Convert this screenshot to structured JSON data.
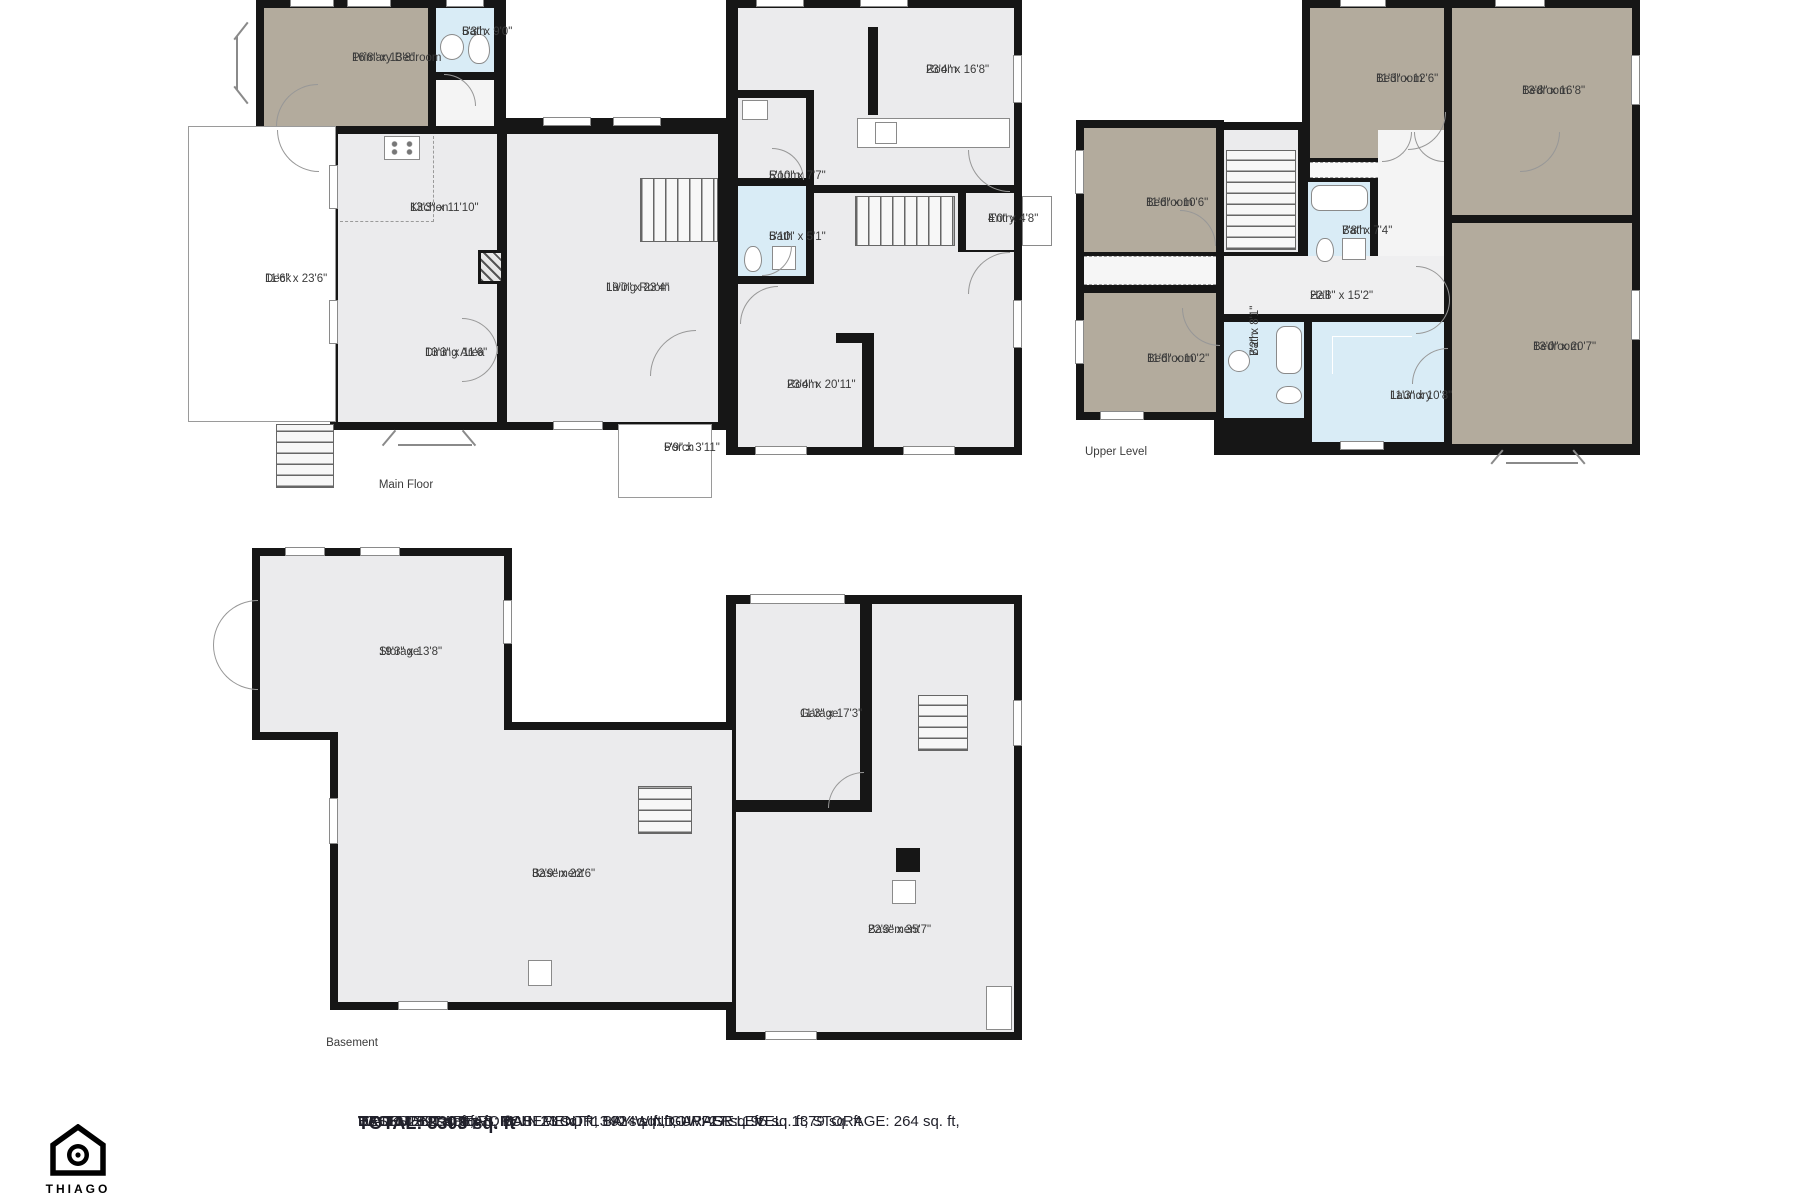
{
  "colors": {
    "wall": "#161616",
    "bedroom": "#b3ab9d",
    "bath": "#d9ecf6",
    "room": "#ebebed",
    "hall": "#efeff0",
    "label_text": "#3b3b3b",
    "summary_text": "#21212b"
  },
  "floors": {
    "main": {
      "label": "Main Floor",
      "rooms": {
        "deck": {
          "name": "Deck",
          "dims": "11'6\" x 23'6\""
        },
        "primary_bedroom": {
          "name": "Primary Bedroom",
          "dims": "16'8\" x 13'8\""
        },
        "bath": {
          "name": "Bath",
          "dims": "5'3\" x 9'0\""
        },
        "kitchen": {
          "name": "Kitchen",
          "dims": "13'3\" x 11'10\""
        },
        "dining": {
          "name": "Dining Area",
          "dims": "13'3\" x 11'6\""
        },
        "living": {
          "name": "Living Room",
          "dims": "19'0\" x 23'4\""
        },
        "room_top": {
          "name": "Room",
          "dims": "23'4\" x 16'8\""
        },
        "room_small": {
          "name": "Room",
          "dims": "5'10\" x 7'7\""
        },
        "bath_small": {
          "name": "Bath",
          "dims": "5'10\" x 5'1\""
        },
        "entry": {
          "name": "Entry",
          "dims": "4'0\" x 4'8\""
        },
        "room_bottom": {
          "name": "Room",
          "dims": "23'4\" x 20'11\""
        },
        "porch": {
          "name": "Porch",
          "dims": "5'9\" x 3'11\""
        }
      }
    },
    "upper": {
      "label": "Upper Level",
      "rooms": {
        "bedroom_top_left": {
          "name": "Bedroom",
          "dims": "11'3\" x 12'6\""
        },
        "bedroom_top_right": {
          "name": "Bedroom",
          "dims": "13'8\" x 16'8\""
        },
        "bedroom_left_top": {
          "name": "Bedroom",
          "dims": "11'6\" x 10'6\""
        },
        "bedroom_left_bottom": {
          "name": "Bedroom",
          "dims": "11'6\" x 10'2\""
        },
        "bath_top": {
          "name": "Bath",
          "dims": "7'8\" x 7'4\""
        },
        "hall": {
          "name": "Hall",
          "dims": "22'8\" x 15'2\""
        },
        "bath_bottom": {
          "name": "Bath",
          "dims": "7'2\" x 8'1\""
        },
        "laundry": {
          "name": "Laundry",
          "dims": "11'3\" x 10'8\""
        },
        "bedroom_right": {
          "name": "Bedroom",
          "dims": "13'0\" x 20'7\""
        }
      }
    },
    "basement": {
      "label": "Basement",
      "rooms": {
        "storage": {
          "name": "Storage",
          "dims": "19'3\" x 13'8\""
        },
        "basement_left": {
          "name": "Basement",
          "dims": "32'9\" x 22'6\""
        },
        "garage": {
          "name": "Garage",
          "dims": "11'3\" x 17'3\""
        },
        "basement_right": {
          "name": "Basement",
          "dims": "22'3\" x 35'7\""
        }
      }
    }
  },
  "summary": {
    "total": "TOTAL: 3303 sq. ft",
    "line1": "BASEMENT: 0 sq. ft, MAIN FLOOR: 1924 sq. ft, UPPER LEVEL: 1379 sq. ft",
    "line2": "EXCLUDED AREAS: BASEMENT: 1340 sq. ft, GARAGE: 195 sq. ft, STORAGE: 264 sq. ft,",
    "line3": "DECK: 269 sq. ft, PORCH: 23 sq. ft, BAY WINDOW: 27 sq. ft",
    "line4": "WALLS: 321 sq. ft"
  },
  "brand": {
    "name": "THIAGO",
    "logo_icon": "house-camera-logo"
  }
}
